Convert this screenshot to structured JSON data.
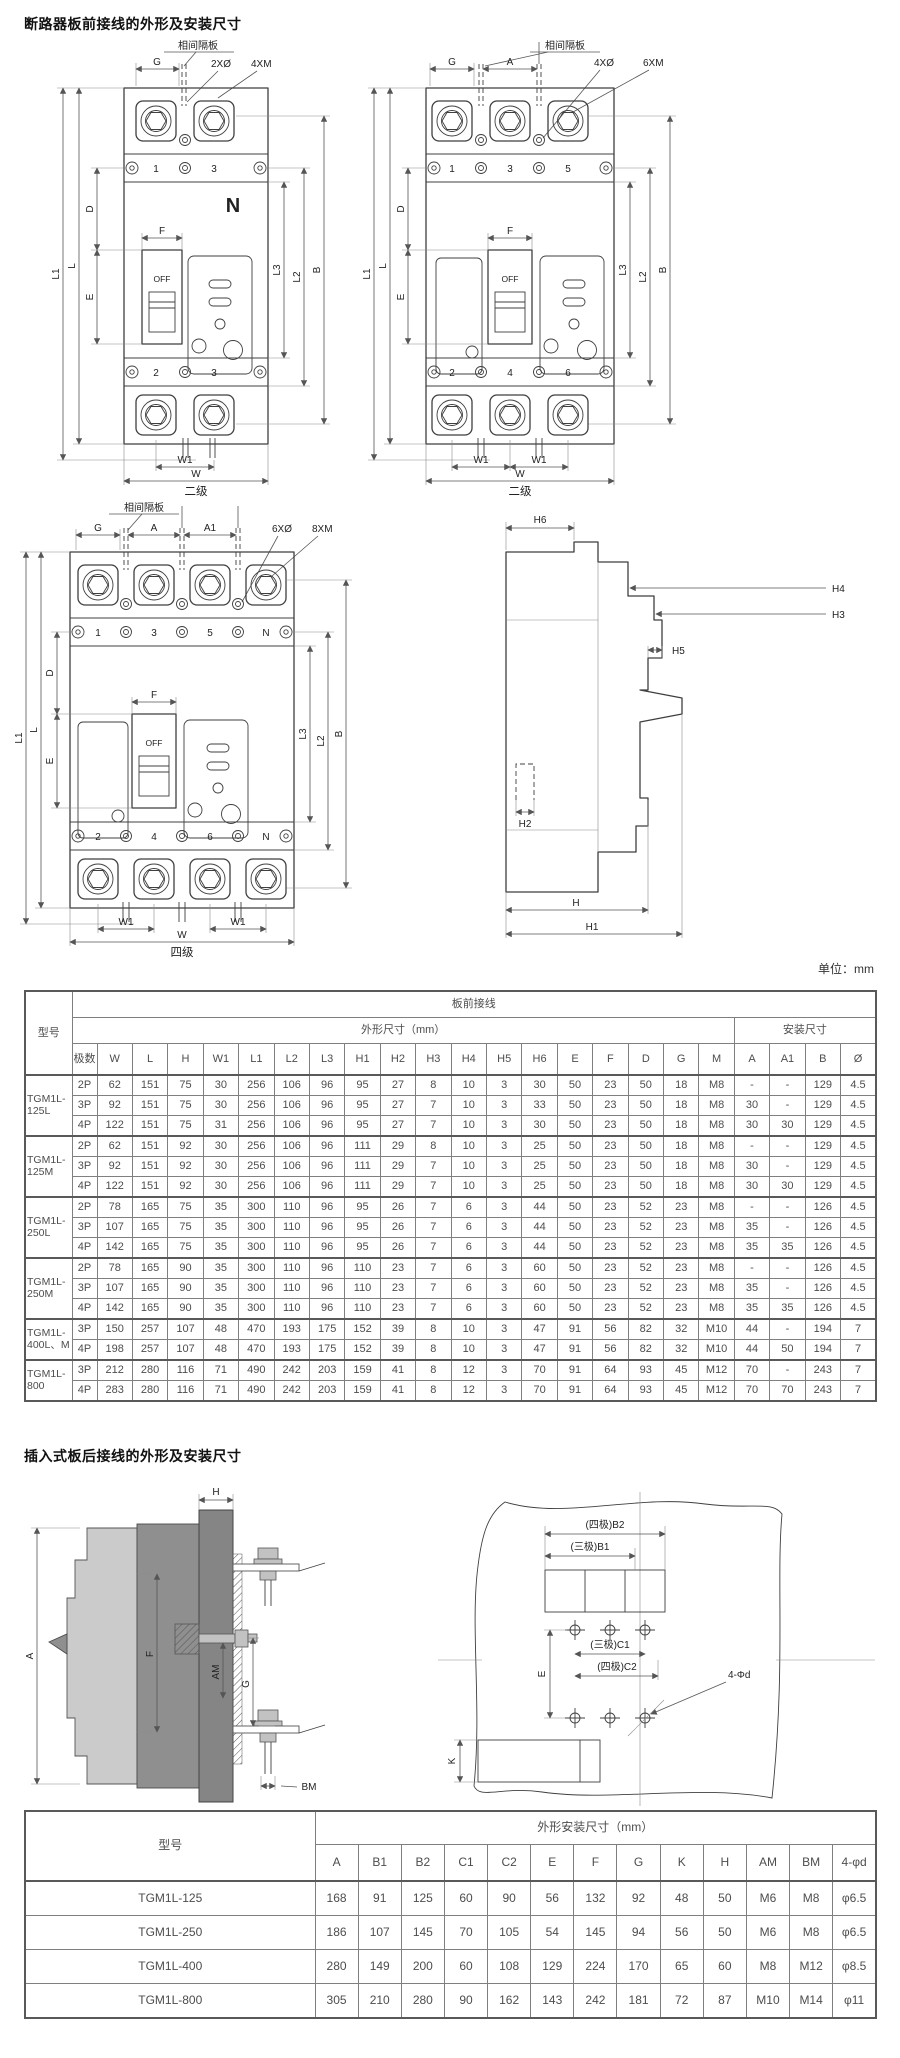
{
  "page": {
    "title1": "断路器板前接线的外形及安装尺寸",
    "title2": "插入式板后接线的外形及安装尺寸",
    "unit_note": "单位：mm"
  },
  "drawings": {
    "d1": {
      "caption": "二级",
      "partition": "相间隔板",
      "g": "G",
      "holes": "2XØ",
      "screws": "4XM",
      "n": "N",
      "off": "OFF",
      "t1": "1",
      "t3": "3",
      "b2": "2",
      "b3": "3",
      "l1": "L1",
      "l": "L",
      "d": "D",
      "e": "E",
      "f": "F",
      "l3": "L3",
      "l2": "L2",
      "b": "B",
      "w1": "W1",
      "w": "W"
    },
    "d2": {
      "caption": "二级",
      "partition": "相间隔板",
      "g": "G",
      "a": "A",
      "holes": "4XØ",
      "screws": "6XM",
      "off": "OFF",
      "t1": "1",
      "t3": "3",
      "t5": "5",
      "b2": "2",
      "b4": "4",
      "b6": "6",
      "l1": "L1",
      "l": "L",
      "d": "D",
      "e": "E",
      "f": "F",
      "l3": "L3",
      "l2": "L2",
      "b": "B",
      "w1": "W1",
      "w": "W"
    },
    "d3": {
      "caption": "四级",
      "partition": "相间隔板",
      "g": "G",
      "a": "A",
      "a1": "A1",
      "holes": "6XØ",
      "screws": "8XM",
      "off": "OFF",
      "t1": "1",
      "t3": "3",
      "t5": "5",
      "tn": "N",
      "b2": "2",
      "b4": "4",
      "b6": "6",
      "bn": "N",
      "l1": "L1",
      "l": "L",
      "d": "D",
      "e": "E",
      "f": "F",
      "l3": "L3",
      "l2": "L2",
      "b": "B",
      "w1": "W1",
      "w": "W"
    },
    "d4": {
      "h": "H",
      "h1": "H1",
      "h2": "H2",
      "h3": "H3",
      "h4": "H4",
      "h5": "H5",
      "h6": "H6"
    },
    "d5": {
      "h": "H",
      "a": "A",
      "f": "F",
      "am": "AM",
      "g": "G",
      "bm": "BM"
    },
    "d6": {
      "b2": "(四极)B2",
      "b1": "(三极)B1",
      "c1": "(三极)C1",
      "c2": "(四极)C2",
      "e": "E",
      "k": "K",
      "holes": "4-Φd"
    }
  },
  "table1": {
    "header": {
      "model": "型号",
      "group": "板前接线",
      "dims": "外形尺寸（mm）",
      "mount": "安装尺寸",
      "poles": "极数",
      "cols": [
        "W",
        "L",
        "H",
        "W1",
        "L1",
        "L2",
        "L3",
        "H1",
        "H2",
        "H3",
        "H4",
        "H5",
        "H6",
        "E",
        "F",
        "D",
        "G",
        "M",
        "A",
        "A1",
        "B",
        "Ø"
      ]
    },
    "groups": [
      {
        "model": "TGM1L-125L",
        "rows": [
          {
            "p": "2P",
            "v": [
              "62",
              "151",
              "75",
              "30",
              "256",
              "106",
              "96",
              "95",
              "27",
              "8",
              "10",
              "3",
              "30",
              "50",
              "23",
              "50",
              "18",
              "M8",
              "-",
              "-",
              "129",
              "4.5"
            ]
          },
          {
            "p": "3P",
            "v": [
              "92",
              "151",
              "75",
              "30",
              "256",
              "106",
              "96",
              "95",
              "27",
              "7",
              "10",
              "3",
              "33",
              "50",
              "23",
              "50",
              "18",
              "M8",
              "30",
              "-",
              "129",
              "4.5"
            ]
          },
          {
            "p": "4P",
            "v": [
              "122",
              "151",
              "75",
              "31",
              "256",
              "106",
              "96",
              "95",
              "27",
              "7",
              "10",
              "3",
              "30",
              "50",
              "23",
              "50",
              "18",
              "M8",
              "30",
              "30",
              "129",
              "4.5"
            ]
          }
        ]
      },
      {
        "model": "TGM1L-125M",
        "rows": [
          {
            "p": "2P",
            "v": [
              "62",
              "151",
              "92",
              "30",
              "256",
              "106",
              "96",
              "111",
              "29",
              "8",
              "10",
              "3",
              "25",
              "50",
              "23",
              "50",
              "18",
              "M8",
              "-",
              "-",
              "129",
              "4.5"
            ]
          },
          {
            "p": "3P",
            "v": [
              "92",
              "151",
              "92",
              "30",
              "256",
              "106",
              "96",
              "111",
              "29",
              "7",
              "10",
              "3",
              "25",
              "50",
              "23",
              "50",
              "18",
              "M8",
              "30",
              "-",
              "129",
              "4.5"
            ]
          },
          {
            "p": "4P",
            "v": [
              "122",
              "151",
              "92",
              "30",
              "256",
              "106",
              "96",
              "111",
              "29",
              "7",
              "10",
              "3",
              "25",
              "50",
              "23",
              "50",
              "18",
              "M8",
              "30",
              "30",
              "129",
              "4.5"
            ]
          }
        ]
      },
      {
        "model": "TGM1L-250L",
        "rows": [
          {
            "p": "2P",
            "v": [
              "78",
              "165",
              "75",
              "35",
              "300",
              "110",
              "96",
              "95",
              "26",
              "7",
              "6",
              "3",
              "44",
              "50",
              "23",
              "52",
              "23",
              "M8",
              "-",
              "-",
              "126",
              "4.5"
            ]
          },
          {
            "p": "3P",
            "v": [
              "107",
              "165",
              "75",
              "35",
              "300",
              "110",
              "96",
              "95",
              "26",
              "7",
              "6",
              "3",
              "44",
              "50",
              "23",
              "52",
              "23",
              "M8",
              "35",
              "-",
              "126",
              "4.5"
            ]
          },
          {
            "p": "4P",
            "v": [
              "142",
              "165",
              "75",
              "35",
              "300",
              "110",
              "96",
              "95",
              "26",
              "7",
              "6",
              "3",
              "44",
              "50",
              "23",
              "52",
              "23",
              "M8",
              "35",
              "35",
              "126",
              "4.5"
            ]
          }
        ]
      },
      {
        "model": "TGM1L-250M",
        "rows": [
          {
            "p": "2P",
            "v": [
              "78",
              "165",
              "90",
              "35",
              "300",
              "110",
              "96",
              "110",
              "23",
              "7",
              "6",
              "3",
              "60",
              "50",
              "23",
              "52",
              "23",
              "M8",
              "-",
              "-",
              "126",
              "4.5"
            ]
          },
          {
            "p": "3P",
            "v": [
              "107",
              "165",
              "90",
              "35",
              "300",
              "110",
              "96",
              "110",
              "23",
              "7",
              "6",
              "3",
              "60",
              "50",
              "23",
              "52",
              "23",
              "M8",
              "35",
              "-",
              "126",
              "4.5"
            ]
          },
          {
            "p": "4P",
            "v": [
              "142",
              "165",
              "90",
              "35",
              "300",
              "110",
              "96",
              "110",
              "23",
              "7",
              "6",
              "3",
              "60",
              "50",
              "23",
              "52",
              "23",
              "M8",
              "35",
              "35",
              "126",
              "4.5"
            ]
          }
        ]
      },
      {
        "model": "TGM1L-400L、M",
        "rows": [
          {
            "p": "3P",
            "v": [
              "150",
              "257",
              "107",
              "48",
              "470",
              "193",
              "175",
              "152",
              "39",
              "8",
              "10",
              "3",
              "47",
              "91",
              "56",
              "82",
              "32",
              "M10",
              "44",
              "-",
              "194",
              "7"
            ]
          },
          {
            "p": "4P",
            "v": [
              "198",
              "257",
              "107",
              "48",
              "470",
              "193",
              "175",
              "152",
              "39",
              "8",
              "10",
              "3",
              "47",
              "91",
              "56",
              "82",
              "32",
              "M10",
              "44",
              "50",
              "194",
              "7"
            ]
          }
        ]
      },
      {
        "model": "TGM1L-800",
        "rows": [
          {
            "p": "3P",
            "v": [
              "212",
              "280",
              "116",
              "71",
              "490",
              "242",
              "203",
              "159",
              "41",
              "8",
              "12",
              "3",
              "70",
              "91",
              "64",
              "93",
              "45",
              "M12",
              "70",
              "-",
              "243",
              "7"
            ]
          },
          {
            "p": "4P",
            "v": [
              "283",
              "280",
              "116",
              "71",
              "490",
              "242",
              "203",
              "159",
              "41",
              "8",
              "12",
              "3",
              "70",
              "91",
              "64",
              "93",
              "45",
              "M12",
              "70",
              "70",
              "243",
              "7"
            ]
          }
        ]
      }
    ]
  },
  "table2": {
    "header": {
      "model": "型号",
      "group": "外形安装尺寸（mm）",
      "cols": [
        "A",
        "B1",
        "B2",
        "C1",
        "C2",
        "E",
        "F",
        "G",
        "K",
        "H",
        "AM",
        "BM",
        "4-φd"
      ]
    },
    "rows": [
      {
        "model": "TGM1L-125",
        "v": [
          "168",
          "91",
          "125",
          "60",
          "90",
          "56",
          "132",
          "92",
          "48",
          "50",
          "M6",
          "M8",
          "φ6.5"
        ]
      },
      {
        "model": "TGM1L-250",
        "v": [
          "186",
          "107",
          "145",
          "70",
          "105",
          "54",
          "145",
          "94",
          "56",
          "50",
          "M6",
          "M8",
          "φ6.5"
        ]
      },
      {
        "model": "TGM1L-400",
        "v": [
          "280",
          "149",
          "200",
          "60",
          "108",
          "129",
          "224",
          "170",
          "65",
          "60",
          "M8",
          "M12",
          "φ8.5"
        ]
      },
      {
        "model": "TGM1L-800",
        "v": [
          "305",
          "210",
          "280",
          "90",
          "162",
          "143",
          "242",
          "181",
          "72",
          "87",
          "M10",
          "M14",
          "φ11"
        ]
      }
    ]
  }
}
